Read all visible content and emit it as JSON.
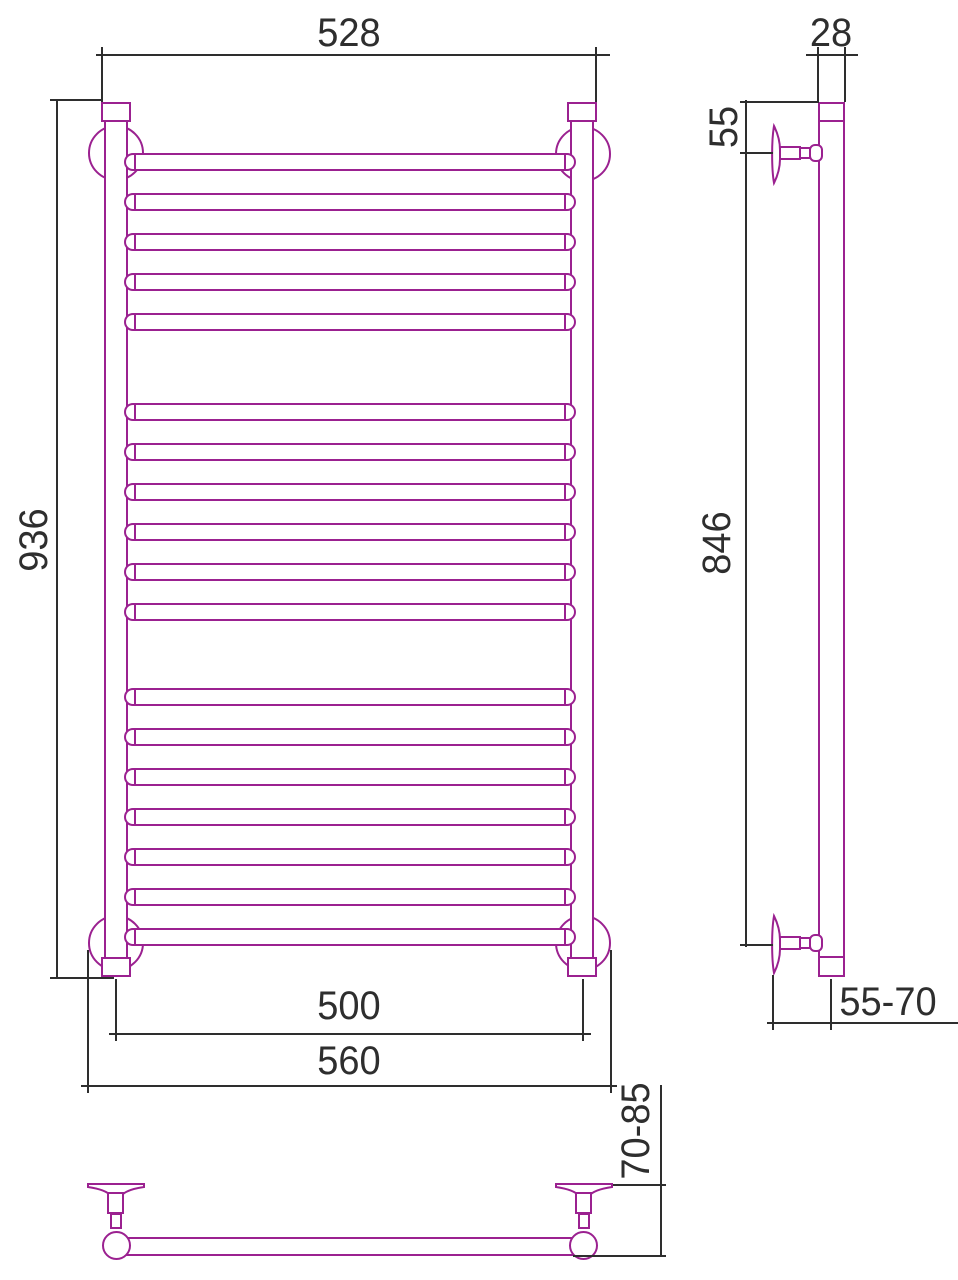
{
  "drawing": {
    "kind": "towel-rail-technical-drawing",
    "colors": {
      "product_line": "#9b2190",
      "dimension_line": "#2e2e2e",
      "background": "#ffffff"
    },
    "labels": {
      "top_width": "528",
      "overall_height": "936",
      "mounting_width": "500",
      "overall_width": "560",
      "profile_depth": "28",
      "top_bracket_offset": "55",
      "bracket_spacing": "846",
      "wall_clearance_side": "55-70",
      "wall_clearance_bottom": "70-85"
    }
  }
}
